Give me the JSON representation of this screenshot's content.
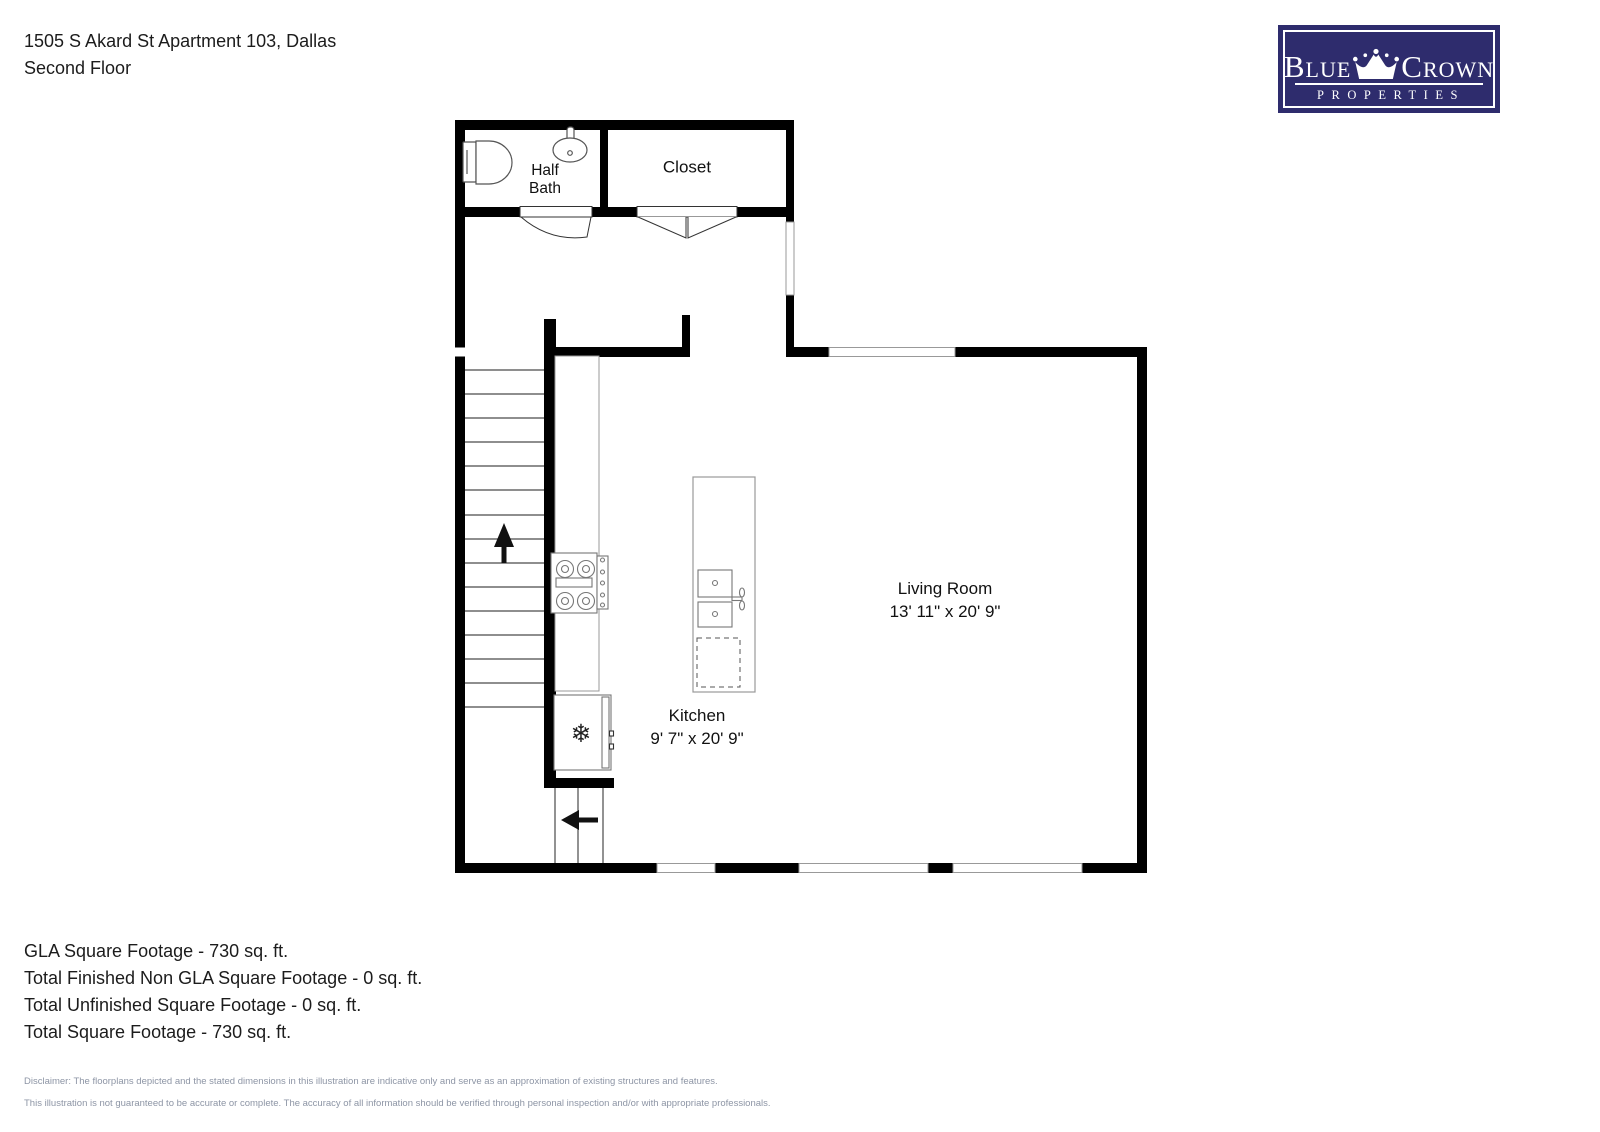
{
  "header": {
    "address": "1505 S Akard St Apartment 103, Dallas",
    "floor": "Second Floor"
  },
  "logo": {
    "brand_left": "Blue",
    "brand_right": "Crown",
    "tagline": "PROPERTIES",
    "bg_color": "#2e2c6d",
    "fg_color": "#ffffff"
  },
  "rooms": {
    "half_bath": {
      "line1": "Half",
      "line2": "Bath"
    },
    "closet": {
      "name": "Closet"
    },
    "living_room": {
      "name": "Living Room",
      "dims": "13' 11\" x 20' 9\""
    },
    "kitchen": {
      "name": "Kitchen",
      "dims": "9' 7\" x 20' 9\""
    }
  },
  "icons": {
    "fridge_snowflake": "❄"
  },
  "footer": {
    "lines": [
      "GLA Square Footage - 730 sq. ft.",
      "Total Finished Non GLA Square Footage - 0 sq. ft.",
      "Total Unfinished Square Footage - 0 sq. ft.",
      "Total Square Footage - 730 sq. ft."
    ]
  },
  "disclaimer": {
    "line1": "Disclaimer: The floorplans depicted and the stated dimensions in this illustration are indicative only and serve as an approximation of existing structures and features.",
    "line2": "This illustration is not guaranteed to be accurate or complete. The accuracy of all information should be verified through personal inspection and/or with appropriate professionals."
  },
  "colors": {
    "wall": "#000000",
    "window_stroke": "#999999",
    "fixture_stroke": "#777777",
    "disclaimer_text": "#8d95a5",
    "logo_navy": "#2e2c6d"
  }
}
